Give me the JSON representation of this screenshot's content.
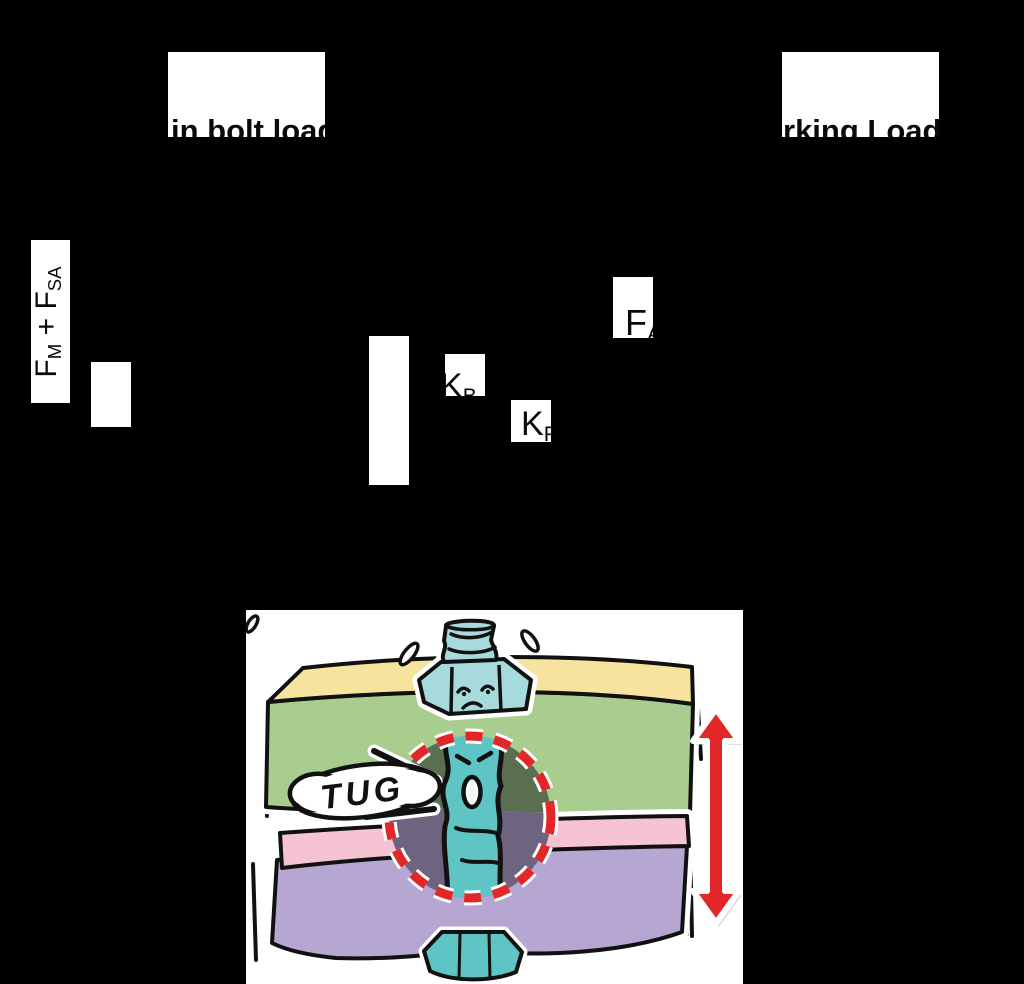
{
  "slide": {
    "background": "#000000",
    "placeholders": {
      "left_caption": "in bolt load",
      "right_caption": "rking Load F"
    },
    "labels": {
      "axis": {
        "f1": "F",
        "sub1": "M",
        "op": " + ",
        "f2": "F",
        "sub2": "SA"
      },
      "kb": {
        "main": "K",
        "sub": "B"
      },
      "kp": {
        "main": "K",
        "sub": "P"
      },
      "fa": {
        "main": "F",
        "sub": "A"
      }
    },
    "illustration": {
      "speech_text": "TUG",
      "colors": {
        "plate_top_yellow": "#F6E49E",
        "plate_front_green": "#A9CC8F",
        "plate_top_pink": "#F6C3D3",
        "plate_front_purple": "#B5A7D1",
        "bolt_teal": "#A7DADC",
        "shank_teal": "#5FC4C4",
        "hole_olive": "#5A6F50",
        "hole_purple": "#6F6480",
        "accent_red": "#E12727",
        "ink": "#111111"
      }
    }
  }
}
